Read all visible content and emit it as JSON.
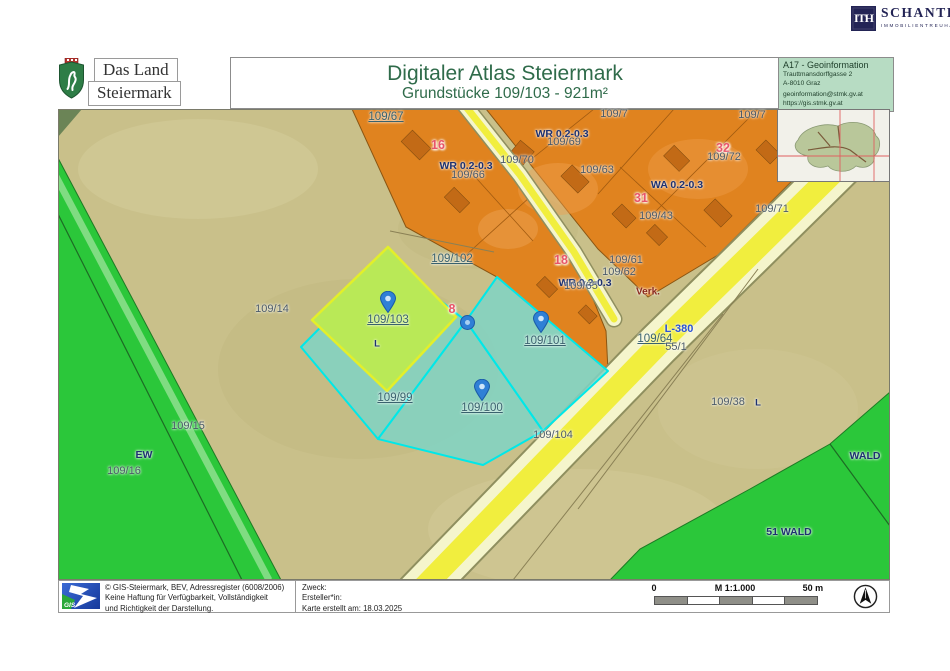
{
  "brand": {
    "monogram": "ITH",
    "name": "SCHANTL",
    "tagline": "IMMOBILIENTREUHAND"
  },
  "header": {
    "org_line1": "Das Land",
    "org_line2": "Steiermark",
    "title": "Digitaler Atlas Steiermark",
    "subtitle": "Grundstücke 109/103 - 921m²",
    "info": {
      "line1": "A17 - Geoinformation",
      "line2": "Trauttmansdorffgasse 2",
      "line3": "A-8010 Graz",
      "line4": "geoinformation@stmk.gv.at",
      "line5": "https://gis.stmk.gv.at"
    }
  },
  "map": {
    "colors": {
      "olive_base": "#c9c08a",
      "residential_orange": "#e0831f",
      "forest_green": "#2bc73a",
      "road_yellow": "#f1ee3e",
      "road_shoulder": "#f5f5cc",
      "selection_teal": "#7fd3c4",
      "selected_parcel_green": "#b9e957",
      "selection_outline_cyan": "#00e8e8",
      "pin_blue": "#2f80d6"
    },
    "labels": [
      {
        "t": "109/67",
        "x": 328,
        "y": 8,
        "c": "link"
      },
      {
        "t": "16",
        "x": 380,
        "y": 36,
        "c": "red"
      },
      {
        "t": "WR 0.2-0.3",
        "x": 408,
        "y": 57,
        "c": "zone"
      },
      {
        "t": "109/66",
        "x": 410,
        "y": 66,
        "c": "plain"
      },
      {
        "t": "109/70",
        "x": 459,
        "y": 51,
        "c": "plain"
      },
      {
        "t": "WR 0.2-0.3",
        "x": 504,
        "y": 25,
        "c": "zone"
      },
      {
        "t": "109/69",
        "x": 506,
        "y": 33,
        "c": "plain"
      },
      {
        "t": "109/7",
        "x": 556,
        "y": 5,
        "c": "plain"
      },
      {
        "t": "109/7",
        "x": 694,
        "y": 6,
        "c": "plain"
      },
      {
        "t": "109/63",
        "x": 539,
        "y": 61,
        "c": "plain"
      },
      {
        "t": "31",
        "x": 583,
        "y": 89,
        "c": "red"
      },
      {
        "t": "109/43",
        "x": 598,
        "y": 107,
        "c": "plain"
      },
      {
        "t": "WA 0.2-0.3",
        "x": 619,
        "y": 76,
        "c": "zone"
      },
      {
        "t": "32",
        "x": 665,
        "y": 39,
        "c": "red"
      },
      {
        "t": "109/72",
        "x": 666,
        "y": 48,
        "c": "plain"
      },
      {
        "t": "109/71",
        "x": 714,
        "y": 100,
        "c": "plain"
      },
      {
        "t": "18",
        "x": 503,
        "y": 151,
        "c": "red"
      },
      {
        "t": "WR 0.2-0.3",
        "x": 527,
        "y": 174,
        "c": "zone"
      },
      {
        "t": "109/65",
        "x": 523,
        "y": 177,
        "c": "plain"
      },
      {
        "t": "109/61",
        "x": 568,
        "y": 151,
        "c": "plain"
      },
      {
        "t": "109/62",
        "x": 561,
        "y": 163,
        "c": "plain"
      },
      {
        "t": "Verk.",
        "x": 590,
        "y": 183,
        "c": "verk"
      },
      {
        "t": "L-380",
        "x": 621,
        "y": 220,
        "c": "road"
      },
      {
        "t": "109/64",
        "x": 597,
        "y": 230,
        "c": "link"
      },
      {
        "t": "55/1",
        "x": 618,
        "y": 238,
        "c": "plain"
      },
      {
        "t": "109/102",
        "x": 394,
        "y": 150,
        "c": "link"
      },
      {
        "t": "8",
        "x": 394,
        "y": 200,
        "c": "red"
      },
      {
        "t": "109/103",
        "x": 330,
        "y": 211,
        "c": "link"
      },
      {
        "t": "L",
        "x": 319,
        "y": 235,
        "c": "zsm"
      },
      {
        "t": "109/101",
        "x": 487,
        "y": 232,
        "c": "link"
      },
      {
        "t": "109/99",
        "x": 337,
        "y": 289,
        "c": "link"
      },
      {
        "t": "109/100",
        "x": 424,
        "y": 299,
        "c": "link"
      },
      {
        "t": "109/104",
        "x": 495,
        "y": 326,
        "c": "plain"
      },
      {
        "t": "109/14",
        "x": 214,
        "y": 200,
        "c": "plain"
      },
      {
        "t": "109/15",
        "x": 130,
        "y": 317,
        "c": "plain"
      },
      {
        "t": "EW",
        "x": 86,
        "y": 346,
        "c": "zone"
      },
      {
        "t": "109/16",
        "x": 66,
        "y": 362,
        "c": "plain"
      },
      {
        "t": "109/38",
        "x": 670,
        "y": 293,
        "c": "plain"
      },
      {
        "t": "L",
        "x": 700,
        "y": 294,
        "c": "zsm"
      },
      {
        "t": "WALD",
        "x": 807,
        "y": 347,
        "c": "zone"
      },
      {
        "t": "51 WALD",
        "x": 731,
        "y": 423,
        "c": "zone"
      }
    ],
    "markers": [
      {
        "parcel": "109/103",
        "x": 330,
        "y": 204,
        "k": "pin"
      },
      {
        "parcel": "109/101",
        "x": 483,
        "y": 224,
        "k": "pin"
      },
      {
        "parcel": "109/100",
        "x": 424,
        "y": 292,
        "k": "pin"
      },
      {
        "parcel": "parcel-junction",
        "x": 408,
        "y": 212,
        "k": "node"
      }
    ]
  },
  "footer": {
    "gis_text": "GIS.",
    "copyright1": "© GIS-Steiermark, BEV, Adressregister (6008/2006)",
    "copyright2": "Keine Haftung für Verfügbarkeit, Vollständigkeit",
    "copyright3": "und Richtigkeit der Darstellung.",
    "meta1": "Zweck:",
    "meta2": "Ersteller*in:",
    "meta3": "Karte erstellt am: 18.03.2025",
    "scale": {
      "start": "0",
      "ratio": "M 1:1.000",
      "end": "50 m"
    }
  }
}
